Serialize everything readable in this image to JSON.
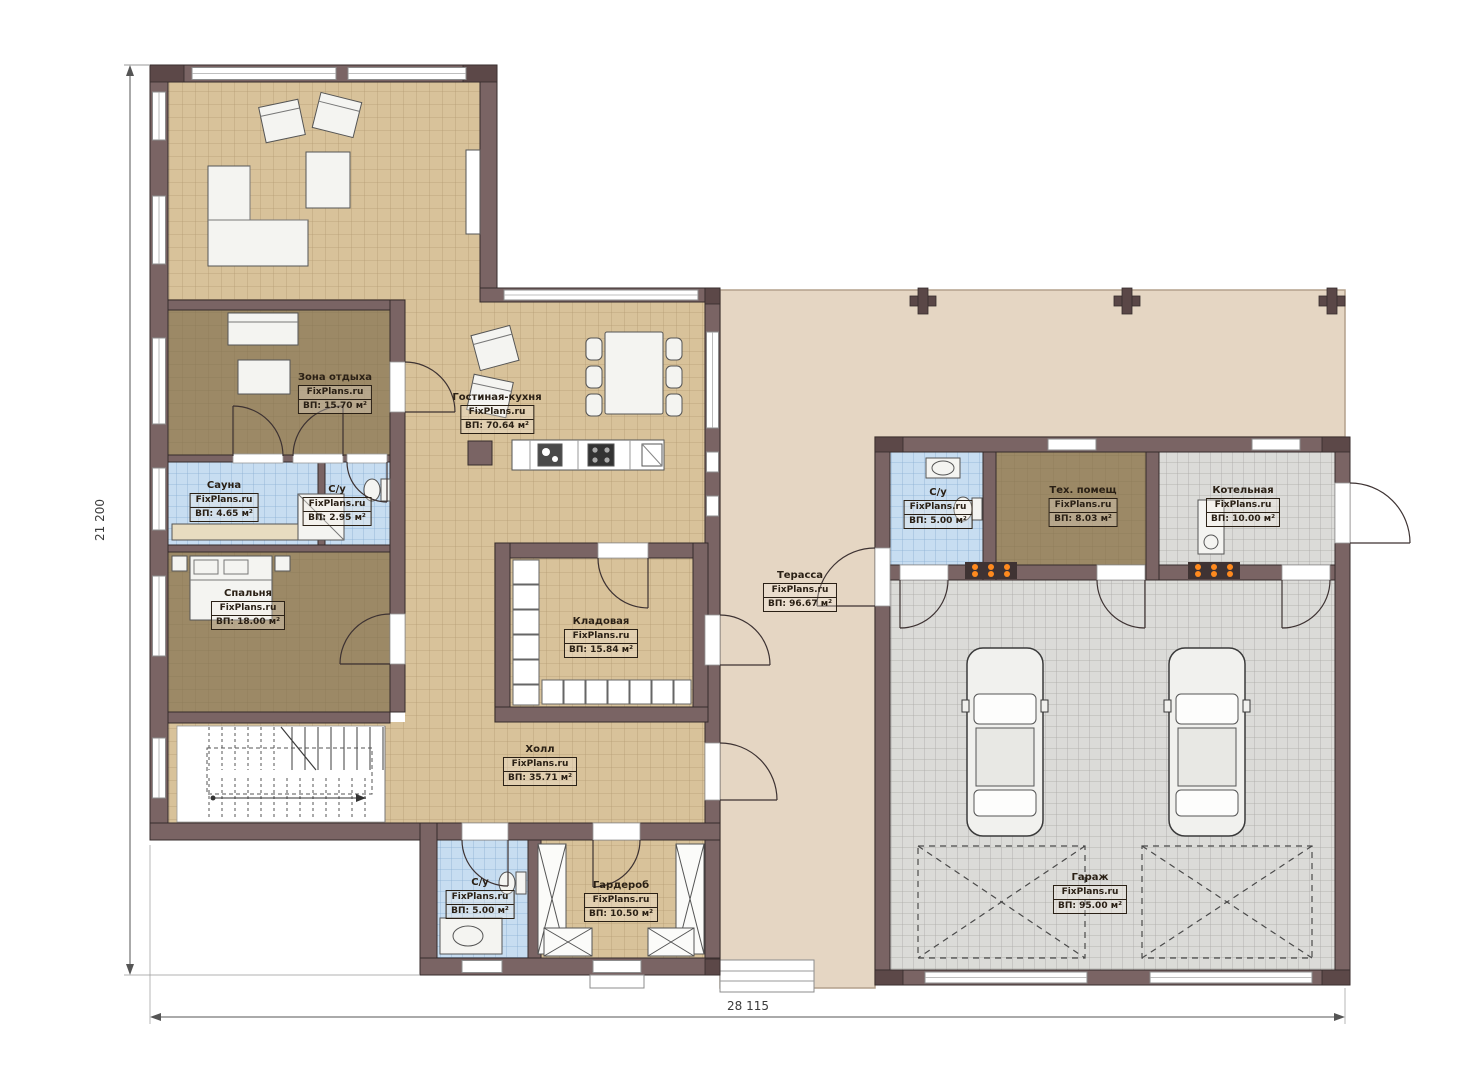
{
  "watermark": "FixPlans.ru",
  "rooms": [
    {
      "name": "Зона отдыха",
      "area": "ВП: 15.70 м²"
    },
    {
      "name": "Гостиная-кухня",
      "area": "ВП: 70.64 м²"
    },
    {
      "name": "Сауна",
      "area": "ВП: 4.65 м²"
    },
    {
      "name": "С/у",
      "area": "ВП: 2.95 м²"
    },
    {
      "name": "Спальня",
      "area": "ВП: 18.00 м²"
    },
    {
      "name": "Кладовая",
      "area": "ВП: 15.84 м²"
    },
    {
      "name": "Холл",
      "area": "ВП: 35.71 м²"
    },
    {
      "name": "С/у",
      "area": "ВП: 5.00 м²"
    },
    {
      "name": "Гардероб",
      "area": "ВП: 10.50 м²"
    },
    {
      "name": "Терасса",
      "area": "ВП: 96.67 м²"
    },
    {
      "name": "С/у",
      "area": "ВП: 5.00 м²"
    },
    {
      "name": "Тех. помещ",
      "area": "ВП: 8.03 м²"
    },
    {
      "name": "Котельная",
      "area": "ВП: 10.00 м²"
    },
    {
      "name": "Гараж",
      "area": "ВП: 95.00 м²"
    }
  ],
  "dimensions": {
    "bottom": "28 115",
    "left": "21 200"
  },
  "colors": {
    "wall": "#7a6464",
    "wall_dark": "#5c4848",
    "tile_beige": "#d8c29a",
    "tile_blue": "#c7ddf1",
    "tile_gray": "#dbdbd8",
    "floor_brown": "#9c8966",
    "terrace": "#e5d6c3",
    "radiator_dots": "#ff8a1e"
  }
}
